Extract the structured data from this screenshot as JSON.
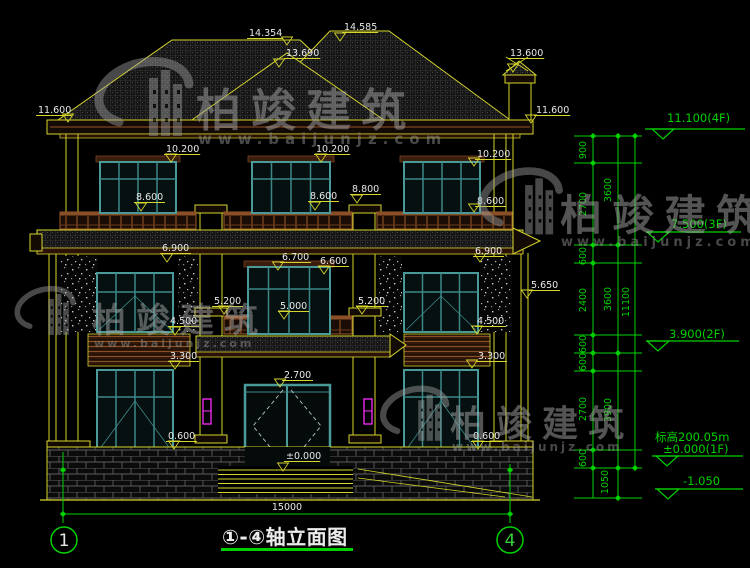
{
  "meta": {
    "drawing_kind": "building front elevation, CAD style",
    "canvas": {
      "w": 750,
      "h": 568
    }
  },
  "colors": {
    "background": "#000000",
    "line_yellow": "#d6d62c",
    "dim_green": "#00d200",
    "text_white": "#e8e8e8",
    "window_teal": "#4a9a9a",
    "window_teal_dark": "#3c8888",
    "railing_brown": "#8a4f26",
    "trim_brown": "#7a4424",
    "lamp_magenta": "#ff2bff",
    "watermark_gray": "#a8a8a8"
  },
  "title": {
    "text": "①-④轴立面图"
  },
  "bottom_dimension": {
    "value": "15000",
    "x": 287,
    "y": 510
  },
  "axis_bubbles": [
    {
      "label": "1",
      "x": 64,
      "y": 540,
      "color": "#e8e8e8"
    },
    {
      "label": "4",
      "x": 510,
      "y": 540,
      "color": "#35d035"
    }
  ],
  "elevation_labels": [
    {
      "t": "14.354",
      "x": 249,
      "y": 36,
      "ax": 287,
      "ay": 45
    },
    {
      "t": "14.585",
      "x": 344,
      "y": 30,
      "ax": 340,
      "ay": 41
    },
    {
      "t": "13.690",
      "x": 286,
      "y": 56,
      "ax": 279,
      "ay": 67
    },
    {
      "t": "13.600",
      "x": 510,
      "y": 56,
      "ax": 513,
      "ay": 72
    },
    {
      "t": "11.600",
      "x": 38,
      "y": 113,
      "ax": 68,
      "ay": 122
    },
    {
      "t": "11.600",
      "x": 536,
      "y": 113,
      "ax": 531,
      "ay": 123
    },
    {
      "t": "10.200",
      "x": 166,
      "y": 152,
      "ax": 171,
      "ay": 162
    },
    {
      "t": "10.200",
      "x": 316,
      "y": 152,
      "ax": 321,
      "ay": 162
    },
    {
      "t": "10.200",
      "x": 477,
      "y": 157,
      "ax": 474,
      "ay": 166
    },
    {
      "t": "8.600",
      "x": 136,
      "y": 200,
      "ax": 141,
      "ay": 211
    },
    {
      "t": "8.600",
      "x": 310,
      "y": 199,
      "ax": 315,
      "ay": 210
    },
    {
      "t": "8.800",
      "x": 352,
      "y": 192,
      "ax": 357,
      "ay": 203
    },
    {
      "t": "8.600",
      "x": 477,
      "y": 204,
      "ax": 474,
      "ay": 212
    },
    {
      "t": "6.900",
      "x": 162,
      "y": 251,
      "ax": 167,
      "ay": 262
    },
    {
      "t": "6.700",
      "x": 282,
      "y": 260,
      "ax": 278,
      "ay": 270
    },
    {
      "t": "6.600",
      "x": 320,
      "y": 264,
      "ax": 324,
      "ay": 274
    },
    {
      "t": "6.900",
      "x": 475,
      "y": 254,
      "ax": 480,
      "ay": 262
    },
    {
      "t": "5.650",
      "x": 531,
      "y": 288,
      "ax": 527,
      "ay": 298
    },
    {
      "t": "5.200",
      "x": 214,
      "y": 304,
      "ax": 224,
      "ay": 314
    },
    {
      "t": "5.000",
      "x": 280,
      "y": 309,
      "ax": 284,
      "ay": 319
    },
    {
      "t": "5.200",
      "x": 358,
      "y": 304,
      "ax": 362,
      "ay": 314
    },
    {
      "t": "4.500",
      "x": 170,
      "y": 324,
      "ax": 175,
      "ay": 335
    },
    {
      "t": "3.300",
      "x": 170,
      "y": 359,
      "ax": 175,
      "ay": 369
    },
    {
      "t": "4.500",
      "x": 477,
      "y": 324,
      "ax": 477,
      "ay": 334
    },
    {
      "t": "3.300",
      "x": 478,
      "y": 359,
      "ax": 472,
      "ay": 368
    },
    {
      "t": "2.700",
      "x": 284,
      "y": 378,
      "ax": 280,
      "ay": 387
    },
    {
      "t": "0.600",
      "x": 168,
      "y": 439,
      "ax": 174,
      "ay": 449
    },
    {
      "t": "0.600",
      "x": 473,
      "y": 439,
      "ax": 478,
      "ay": 449
    },
    {
      "t": "±0.000",
      "x": 286,
      "y": 459,
      "ax": 283,
      "ay": 471
    }
  ],
  "right_chain": {
    "segments": [
      {
        "v": "900",
        "x": 586,
        "y": 150
      },
      {
        "v": "2700",
        "x": 586,
        "y": 204
      },
      {
        "v": "600",
        "x": 586,
        "y": 256
      },
      {
        "v": "2400",
        "x": 586,
        "y": 300
      },
      {
        "v": "600",
        "x": 586,
        "y": 344
      },
      {
        "v": "600",
        "x": 586,
        "y": 362
      },
      {
        "v": "2700",
        "x": 586,
        "y": 409
      },
      {
        "v": "600",
        "x": 586,
        "y": 458
      },
      {
        "v": "3600",
        "x": 611,
        "y": 190
      },
      {
        "v": "3600",
        "x": 611,
        "y": 299
      },
      {
        "v": "3900",
        "x": 611,
        "y": 410
      },
      {
        "v": "1050",
        "x": 608,
        "y": 482
      },
      {
        "v": "11100",
        "x": 629,
        "y": 302
      }
    ]
  },
  "floor_markers": [
    {
      "lines": [
        "11.100(4F)"
      ],
      "tx": 667,
      "ty": 122,
      "lineY": 129,
      "x1": 645,
      "x2": 745,
      "apex": 663
    },
    {
      "lines": [
        "7.500(3F)"
      ],
      "tx": 671,
      "ty": 228,
      "lineY": 232,
      "x1": 646,
      "x2": 741,
      "apex": 658
    },
    {
      "lines": [
        "3.900(2F)"
      ],
      "tx": 669,
      "ty": 338,
      "lineY": 341,
      "x1": 646,
      "x2": 739,
      "apex": 658
    },
    {
      "lines": [
        "标高200.05m",
        "±0.000(1F)"
      ],
      "tx": 655,
      "ty": 441,
      "ty2": 453,
      "lineY": 456,
      "x1": 652,
      "x2": 743,
      "apex": 667
    },
    {
      "lines": [
        "-1.050"
      ],
      "tx": 683,
      "ty": 485,
      "lineY": 489,
      "x1": 655,
      "x2": 743,
      "apex": 668
    }
  ],
  "watermarks": [
    {
      "brand": "柏竣建筑",
      "url": "www.baijunjz.com",
      "lx": 163,
      "ly": 112,
      "ls": 1.0,
      "tx": 196,
      "ty": 126,
      "fs": 45,
      "ux": 198,
      "uy": 144,
      "ufs": 15,
      "uls": 6
    },
    {
      "brand": "柏竣建筑",
      "url": "www.baijunjz.com",
      "lx": 57,
      "ly": 320,
      "ls": 0.62,
      "tx": 92,
      "ty": 332,
      "fs": 34,
      "ux": 94,
      "uy": 347,
      "ufs": 11,
      "uls": 3
    },
    {
      "brand": "柏竣建筑",
      "url": "www.baijunjz.com",
      "lx": 537,
      "ly": 214,
      "ls": 0.85,
      "tx": 560,
      "ty": 230,
      "fs": 42,
      "ux": 561,
      "uy": 246,
      "ufs": 13,
      "uls": 4
    },
    {
      "brand": "柏竣建筑",
      "url": "www.baijunjz.com",
      "lx": 428,
      "ly": 424,
      "ls": 0.7,
      "tx": 450,
      "ty": 436,
      "fs": 36,
      "ux": 452,
      "uy": 451,
      "ufs": 12,
      "uls": 3
    }
  ]
}
